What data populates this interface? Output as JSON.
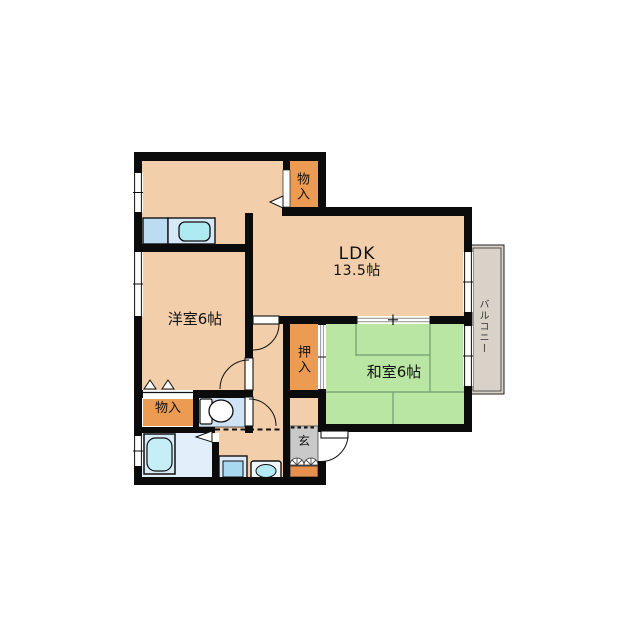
{
  "floorplan": {
    "rooms": {
      "ldk": {
        "name": "LDK",
        "size": "13.5帖"
      },
      "western": {
        "label": "洋室6帖"
      },
      "japanese": {
        "label": "和室6帖"
      },
      "balcony": {
        "label": "バルコニー"
      },
      "closet_top": {
        "label": "物入"
      },
      "oshiire": {
        "label": "押入"
      },
      "closet_bottom": {
        "label": "物入"
      },
      "entrance": {
        "label": "玄"
      }
    },
    "colors": {
      "wall": "#0b0b0b",
      "room_floor": "#f2cfaa",
      "tatami": "#b9e6a3",
      "tatami_line": "#6f9d6f",
      "closet": "#eb9b52",
      "balcony_floor": "#d9d2c9",
      "entrance_tile": "#c9c9c9",
      "entrance_step": "#e8914f",
      "counter": "#bcdcf2",
      "counter_top": "#d6e9f8",
      "sink": "#aeeaf2",
      "bath_floor": "#e2eef9",
      "tub": "#c6eef6",
      "toilet_floor": "#cfe3f5",
      "basin": "#a9d9f2",
      "washer": "#b4eaf4"
    }
  }
}
